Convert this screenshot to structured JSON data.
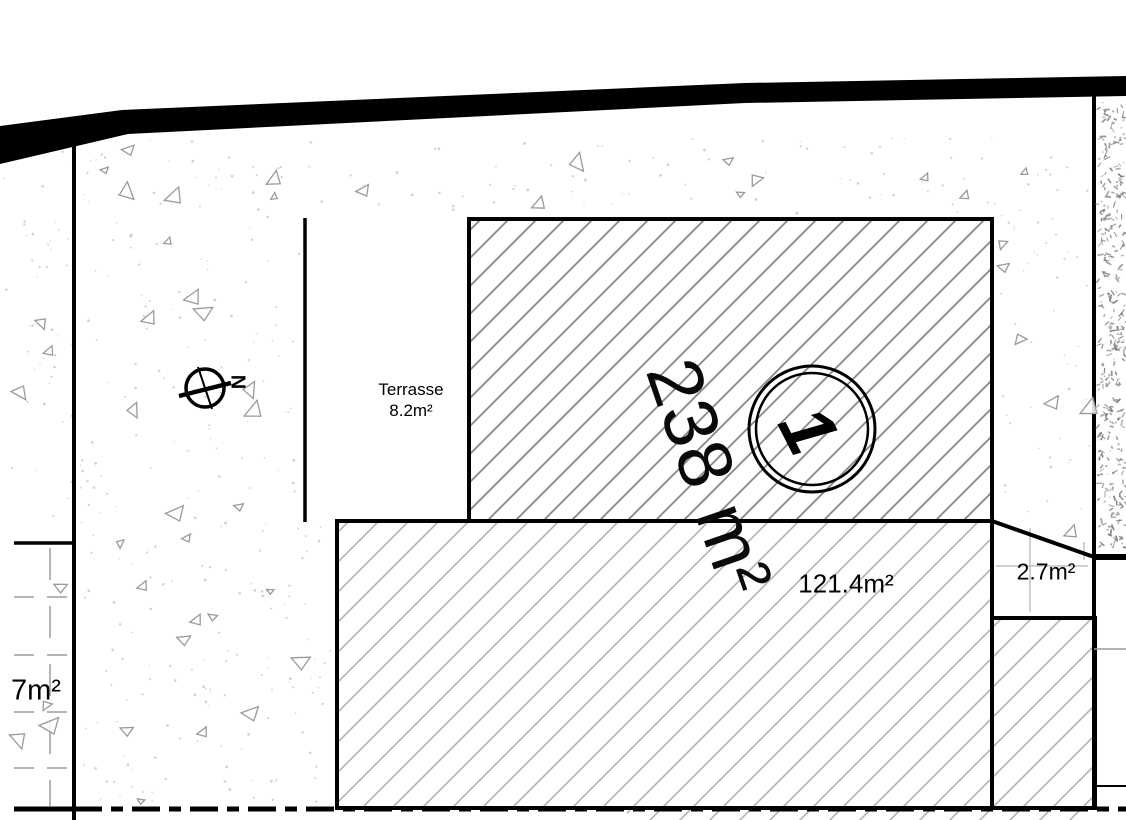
{
  "plan": {
    "labels": {
      "terrace_name": "Terrasse",
      "terrace_area": "8.2m²",
      "parcel_area": "238 m²",
      "lot_number": "1",
      "building_area": "121.4m²",
      "side_area": "2.7m²",
      "left_area": "7m²",
      "north": "N"
    },
    "style": {
      "ink": "#000000",
      "hatch_dark": "#878787",
      "hatch_light": "#b2b2b2",
      "vegetation": "#9a9a9a",
      "speckle": "#aaaaaa",
      "gravel": "#777777",
      "grid_gray": "#b5b5b5",
      "faint_line": "#c0c0c0"
    }
  }
}
